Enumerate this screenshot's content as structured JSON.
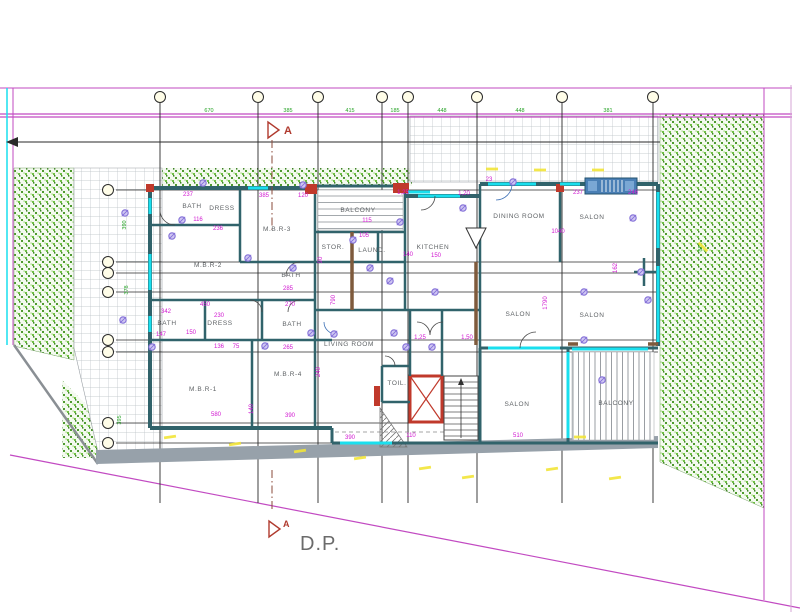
{
  "drawing": {
    "dp_label": "D.P.",
    "section_marker_label": "A",
    "colors": {
      "wall": "#31636b",
      "window_cyan": "#19dfee",
      "boundary_magenta": "#c24ac2",
      "dimension_magenta": "#d118d1",
      "dimension_green": "#27a327",
      "greenery": "#55a433",
      "red_accent": "#c0392b",
      "brown_accent": "#7e5a3c",
      "symbol_purple": "#8470d8",
      "road_yellow": "#f2e437",
      "grid_black": "#2a2a2a"
    },
    "rooms": [
      {
        "label": "BATH",
        "x": 192,
        "y": 208
      },
      {
        "label": "DRESS",
        "x": 222,
        "y": 210
      },
      {
        "label": "M.B.R-3",
        "x": 277,
        "y": 231
      },
      {
        "label": "BALCONY",
        "x": 358,
        "y": 212
      },
      {
        "label": "STOR.",
        "x": 333,
        "y": 249
      },
      {
        "label": "LAUND.",
        "x": 372,
        "y": 252
      },
      {
        "label": "KITCHEN",
        "x": 433,
        "y": 249
      },
      {
        "label": "DINING ROOM",
        "x": 519,
        "y": 218
      },
      {
        "label": "SALON",
        "x": 592,
        "y": 219
      },
      {
        "label": "M.B.R-2",
        "x": 208,
        "y": 267
      },
      {
        "label": "BATH",
        "x": 291,
        "y": 277
      },
      {
        "label": "SALON",
        "x": 518,
        "y": 316
      },
      {
        "label": "SALON",
        "x": 592,
        "y": 317
      },
      {
        "label": "BATH",
        "x": 167,
        "y": 325
      },
      {
        "label": "DRESS",
        "x": 220,
        "y": 325
      },
      {
        "label": "BATH",
        "x": 292,
        "y": 326
      },
      {
        "label": "LIVING ROOM",
        "x": 349,
        "y": 346
      },
      {
        "label": "M.B.R-1",
        "x": 203,
        "y": 391
      },
      {
        "label": "M.B.R-4",
        "x": 288,
        "y": 376
      },
      {
        "label": "TOIL.",
        "x": 397,
        "y": 385
      },
      {
        "label": "SALON",
        "x": 517,
        "y": 406
      },
      {
        "label": "BALCONY",
        "x": 616,
        "y": 405
      }
    ],
    "dims_magenta": [
      {
        "t": "237",
        "x": 188,
        "y": 196
      },
      {
        "t": "116",
        "x": 198,
        "y": 221
      },
      {
        "t": "236",
        "x": 218,
        "y": 230
      },
      {
        "t": "450",
        "x": 205,
        "y": 306
      },
      {
        "t": "342",
        "x": 166,
        "y": 313
      },
      {
        "t": "230",
        "x": 219,
        "y": 317
      },
      {
        "t": "147",
        "x": 161,
        "y": 336
      },
      {
        "t": "150",
        "x": 191,
        "y": 334
      },
      {
        "t": "136",
        "x": 219,
        "y": 348
      },
      {
        "t": "75",
        "x": 236,
        "y": 348
      },
      {
        "t": "265",
        "x": 288,
        "y": 349
      },
      {
        "t": "580",
        "x": 216,
        "y": 416
      },
      {
        "t": "390",
        "x": 290,
        "y": 417
      },
      {
        "t": "140",
        "x": 253,
        "y": 409,
        "rot": 1
      },
      {
        "t": "390",
        "x": 350,
        "y": 439
      },
      {
        "t": "1,25",
        "x": 403,
        "y": 194
      },
      {
        "t": "1,20",
        "x": 464,
        "y": 195
      },
      {
        "t": "23",
        "x": 489,
        "y": 181
      },
      {
        "t": "237",
        "x": 578,
        "y": 194
      },
      {
        "t": "246",
        "x": 633,
        "y": 194
      },
      {
        "t": "1040",
        "x": 558,
        "y": 233
      },
      {
        "t": "1790",
        "x": 547,
        "y": 303,
        "rot": 1
      },
      {
        "t": "115",
        "x": 367,
        "y": 222
      },
      {
        "t": "105",
        "x": 364,
        "y": 237
      },
      {
        "t": "140",
        "x": 408,
        "y": 256
      },
      {
        "t": "150",
        "x": 436,
        "y": 257
      },
      {
        "t": "790",
        "x": 335,
        "y": 300,
        "rot": 1
      },
      {
        "t": "270",
        "x": 290,
        "y": 306
      },
      {
        "t": "1,25",
        "x": 420,
        "y": 339
      },
      {
        "t": "1,50",
        "x": 467,
        "y": 339
      },
      {
        "t": "510",
        "x": 518,
        "y": 437
      },
      {
        "t": "162",
        "x": 617,
        "y": 268,
        "rot": 1
      },
      {
        "t": "385",
        "x": 264,
        "y": 197
      },
      {
        "t": "120",
        "x": 303,
        "y": 197
      },
      {
        "t": "90",
        "x": 322,
        "y": 260,
        "rot": 1
      },
      {
        "t": "240",
        "x": 320,
        "y": 372,
        "rot": 1
      },
      {
        "t": "285",
        "x": 288,
        "y": 290
      },
      {
        "t": "110",
        "x": 411,
        "y": 437
      }
    ],
    "dims_green": [
      {
        "t": "670",
        "x": 209,
        "y": 112
      },
      {
        "t": "385",
        "x": 288,
        "y": 112
      },
      {
        "t": "415",
        "x": 350,
        "y": 112
      },
      {
        "t": "185",
        "x": 395,
        "y": 112
      },
      {
        "t": "448",
        "x": 442,
        "y": 112
      },
      {
        "t": "448",
        "x": 520,
        "y": 112
      },
      {
        "t": "381",
        "x": 608,
        "y": 112
      },
      {
        "t": "390",
        "x": 126,
        "y": 225,
        "rot": 1
      },
      {
        "t": "378",
        "x": 128,
        "y": 290,
        "rot": 1
      },
      {
        "t": "395",
        "x": 121,
        "y": 420,
        "rot": 1
      },
      {
        "t": "885",
        "x": 702,
        "y": 247,
        "rot": 1
      }
    ],
    "grid": {
      "top_circle_y": 97,
      "top_circles_x": [
        160,
        258,
        318,
        382,
        408,
        477,
        562,
        653
      ],
      "left_circle_x": 108,
      "left_circles_y": [
        190,
        262,
        273,
        292,
        340,
        352,
        423,
        443
      ]
    },
    "symbols": [
      [
        203,
        183
      ],
      [
        303,
        185
      ],
      [
        400,
        222
      ],
      [
        513,
        182
      ],
      [
        633,
        218
      ],
      [
        125,
        213
      ],
      [
        182,
        220
      ],
      [
        172,
        236
      ],
      [
        248,
        258
      ],
      [
        293,
        268
      ],
      [
        353,
        240
      ],
      [
        370,
        268
      ],
      [
        390,
        281
      ],
      [
        435,
        292
      ],
      [
        123,
        320
      ],
      [
        152,
        347
      ],
      [
        265,
        346
      ],
      [
        311,
        333
      ],
      [
        334,
        334
      ],
      [
        394,
        333
      ],
      [
        406,
        347
      ],
      [
        432,
        347
      ],
      [
        584,
        292
      ],
      [
        584,
        340
      ],
      [
        602,
        380
      ],
      [
        641,
        272
      ],
      [
        648,
        300
      ],
      [
        463,
        208
      ]
    ],
    "yellow_dashes": [
      {
        "x": 170,
        "y": 437,
        "r": -8
      },
      {
        "x": 235,
        "y": 444,
        "r": -8
      },
      {
        "x": 300,
        "y": 451,
        "r": -8
      },
      {
        "x": 360,
        "y": 458,
        "r": -8
      },
      {
        "x": 425,
        "y": 468,
        "r": -8
      },
      {
        "x": 468,
        "y": 477,
        "r": -8
      },
      {
        "x": 552,
        "y": 469,
        "r": -8
      },
      {
        "x": 615,
        "y": 478,
        "r": -8
      },
      {
        "x": 492,
        "y": 169,
        "r": 0
      },
      {
        "x": 540,
        "y": 170,
        "r": 0
      },
      {
        "x": 598,
        "y": 170,
        "r": 0
      },
      {
        "x": 580,
        "y": 437,
        "r": 0
      },
      {
        "x": 703,
        "y": 247,
        "r": 45
      }
    ]
  }
}
